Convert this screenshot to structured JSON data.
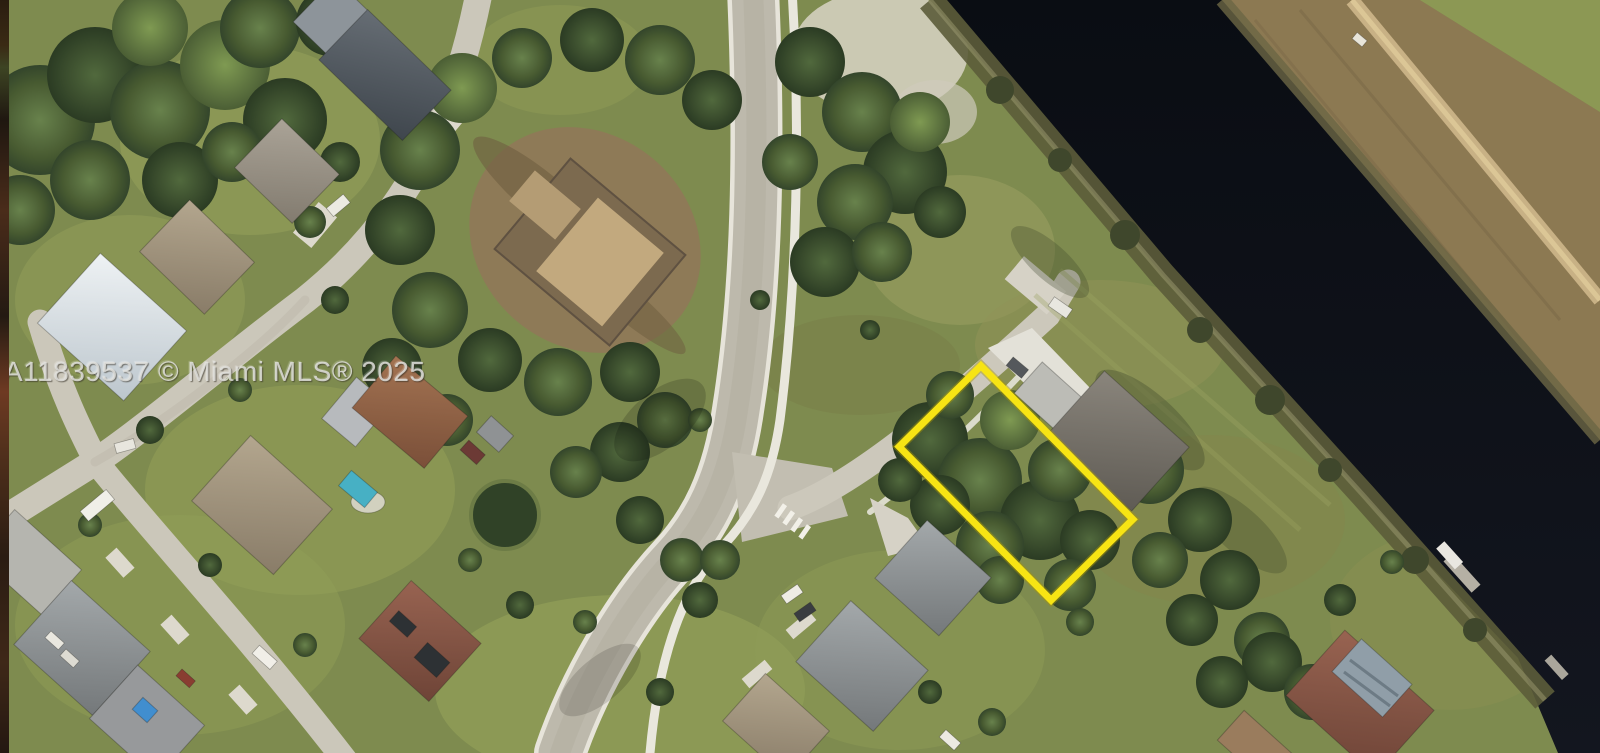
{
  "image": {
    "kind": "aerial-satellite-photo",
    "width_px": 1600,
    "height_px": 753
  },
  "watermark": {
    "text": "A11839537 © Miami MLS® 2025",
    "color": "#E4E4E0"
  },
  "highlight": {
    "label": "highlighted vacant lot boundary",
    "color": "#F8E40C",
    "shape": "rotated rectangle",
    "center_x": 1016,
    "center_y": 483,
    "width_px": 216,
    "height_px": 115,
    "rotation_deg": 45.3
  },
  "palette": {
    "grass_base": "#7E8B4D",
    "grass_light": "#97A35B",
    "grass_olive": "#8F9252",
    "tree_dark": "#324327",
    "tree_light": "#5E7A40",
    "road_concrete": "#C9C5B7",
    "sidewalk_white": "#E9E7DD",
    "dirt_site": "#8F7A55",
    "dirt_strip": "#8D7950",
    "trail": "#C9B183",
    "canal_water": "#0B0E15",
    "bank_vegetation": "#5C5C38",
    "roof_dark_gray": "#4B5157",
    "roof_gray": "#8E8E88",
    "roof_tan": "#A3927A",
    "roof_white_blue": "#CCD4DA",
    "roof_brown_orange": "#95664A",
    "roof_red_brown": "#8A5A46",
    "pool_water": "#43B1C6",
    "blue_tarp": "#3E8ED2",
    "pool_screen": "#8F9EA8"
  },
  "scene": {
    "description": "Overhead aerial photo of a suburban waterfront neighborhood; a yellow rectangle outlines a tree-covered vacant lot beside a gray-roofed house, near a dark canal with a dirt maintenance strip on its far side.",
    "features": [
      "yellow-lot-outline",
      "canal",
      "canal-bank-vegetation",
      "dirt-maintenance-strip-with-trail",
      "far-field-grass",
      "main-road-s-curve",
      "east-sidewalk",
      "crosswalk",
      "side-street-to-lot",
      "curving-residential-street",
      "cross-street-bottom-left",
      "construction-site-dirt-lot",
      "tree-clusters",
      "pale-sand-patch",
      "round-pond-tree",
      "houses-with-gray-tan-white-red-roofs",
      "house-with-blue-tarp-roof",
      "house-with-solar-panels",
      "house-with-pool",
      "house-with-pool-screen-enclosure",
      "dock-with-boat",
      "parked-cars-and-rv",
      "mls-watermark"
    ]
  }
}
